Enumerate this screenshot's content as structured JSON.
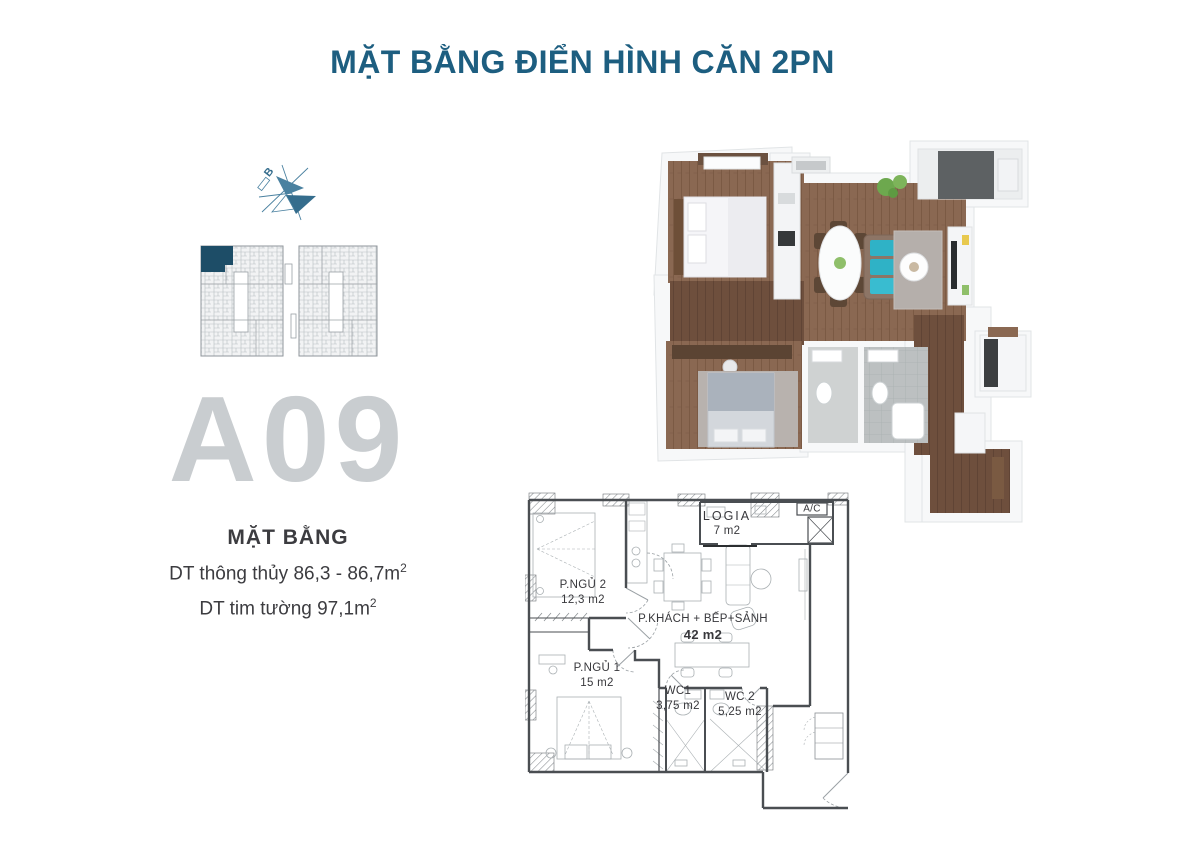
{
  "title": "MẶT BẰNG ĐIỂN HÌNH CĂN 2PN",
  "logo": {
    "letter": "B"
  },
  "unit": {
    "code": "A09",
    "heading": "MẶT BẰNG",
    "area_net_label": "DT thông thủy 86,3 - 86,7m",
    "area_gross_label": "DT tim tường 97,1m",
    "sup": "2"
  },
  "floorplan_2d": {
    "rooms": [
      {
        "name": "LOGIA",
        "area": "7 m2"
      },
      {
        "name": "A/C",
        "area": ""
      },
      {
        "name": "P.NGỦ 2",
        "area": "12,3 m2"
      },
      {
        "name": "P.KHÁCH + BẾP+SẢNH",
        "area": "42 m2"
      },
      {
        "name": "P.NGỦ 1",
        "area": "15 m2"
      },
      {
        "name": "WC1",
        "area": "3,75 m2"
      },
      {
        "name": "WC 2",
        "area": "5,25 m2"
      }
    ]
  },
  "colors": {
    "title_blue": "#1d5e80",
    "logo_blue": "#4a81a0",
    "logo_blue_dark": "#356d8d",
    "unit_code_gray": "#c9cdd0",
    "text_dark": "#3c3c40",
    "keyplan_highlight": "#1d4d67",
    "wall": "#4a4e52",
    "wood": "#8a6852",
    "wood_dark": "#6e4f3d",
    "tile_gray": "#bcc0c1",
    "sofa_teal": "#2fb2c6"
  }
}
